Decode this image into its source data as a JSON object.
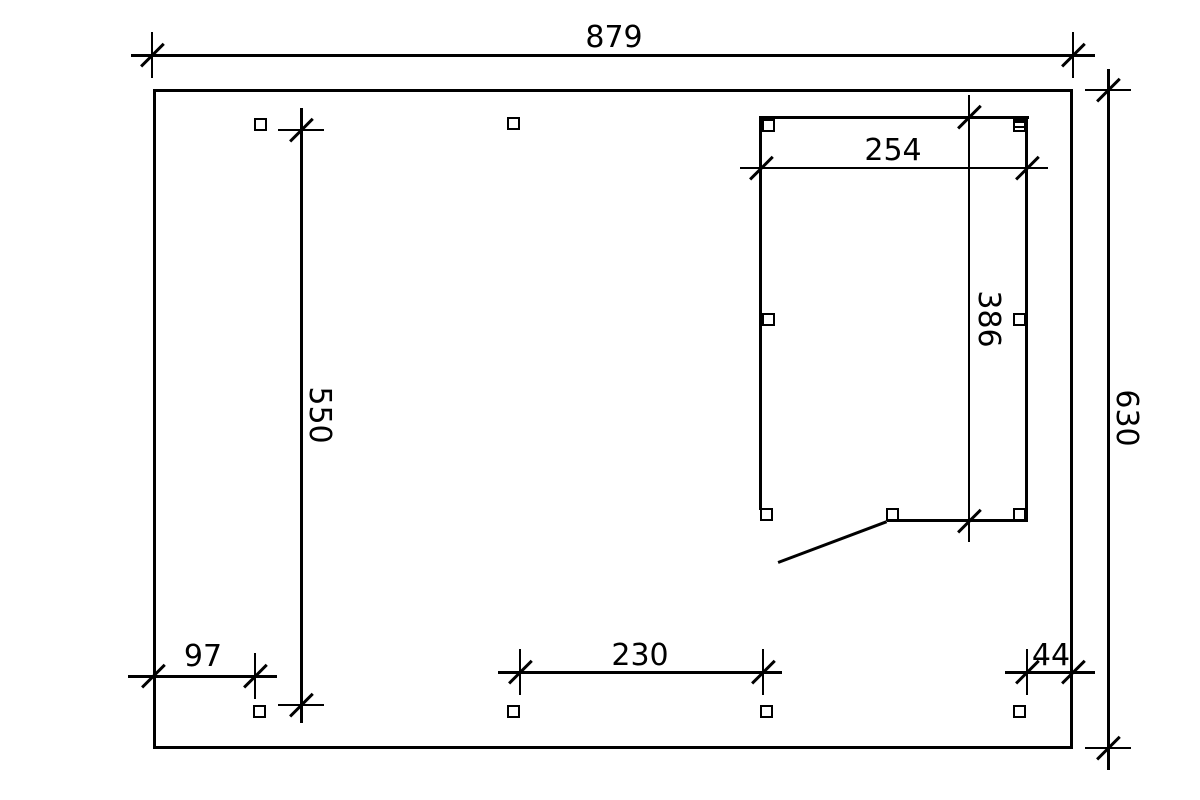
{
  "drawing": {
    "title": "carport-floor-plan",
    "background_color": "#ffffff",
    "line_color": "#000000",
    "dimensions": {
      "total_width": "879",
      "total_height": "630",
      "left_bay_height": "550",
      "room_width": "254",
      "room_height": "386",
      "bottom_left_offset": "97",
      "bottom_mid_span": "230",
      "bottom_right_offset": "44"
    }
  }
}
